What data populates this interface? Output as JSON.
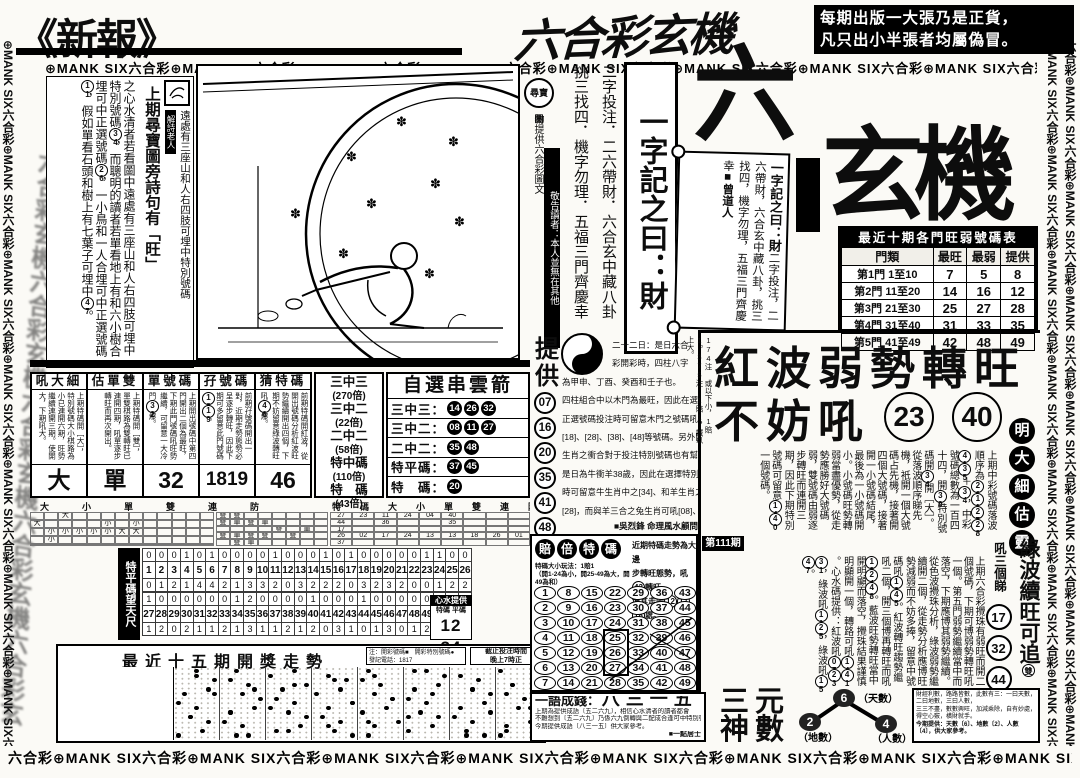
{
  "accent": {
    "ink": "#0d0d0d",
    "paper": "#fbfaf6"
  },
  "borders": {
    "strip_text": "⊕MANK SIX六合彩",
    "strip_text_alt": "六合彩⊕MANK SIX",
    "watermark": "六合彩玄機六合彩玄機六合彩玄機"
  },
  "masthead": {
    "left_logo": "《新報》",
    "center_logo": "六合彩玄機",
    "notice1": "每期出版一大張乃是正貨，",
    "notice2": "凡只出小半張者均屬偽冒。"
  },
  "left_article": {
    "seal_label": "解詩老人",
    "lead": "上期尋寶圖旁詩句有「旺」",
    "body": "之心水清者若看圖中遠處有三座山和人右四肢可埋中特別號碼(34)，而聰明的讀者若單看地上有和六小樹合埋可中正選號碼(26)，一小鳥和一人合埋可中正選號碼(11)，假如單看石頭和樹上有七葉子可埋中(47)。",
    "side_note": "遠處有三座山和人右四肢可埋中特別號碼"
  },
  "center": {
    "treasure_seal": "尋寶圖",
    "provider_note": "物提供六合彩圖文",
    "notice_bar": "敬告讀者：本人並無在其他",
    "col_pick": "挑三找四．機字勿理．五福三門齊慶幸",
    "col_bet": "二字投注．二六帶財．六合玄中藏八卦",
    "motto_box": "一字記之曰：財",
    "big_six": "六",
    "big_title": "玄機",
    "scroll": {
      "l1": "一字記之曰：財",
      "l2": "二字投注，二六帶財，",
      "l3": "六合玄中藏八卦，",
      "l4": "挑三找四，機字勿理，",
      "l5": "五福三門齊慶幸",
      "sign": "■曾道人"
    }
  },
  "hot_table": {
    "title": "最近十期各門旺弱號碼表",
    "rows": [
      [
        "門類",
        "最旺",
        "最弱",
        "提供"
      ],
      [
        "第1門 1至10",
        "7",
        "5",
        "8"
      ],
      [
        "第2門 11至20",
        "14",
        "16",
        "12"
      ],
      [
        "第3門 21至30",
        "25",
        "27",
        "28"
      ],
      [
        "第4門 31至40",
        "31",
        "33",
        "35"
      ],
      [
        "第5門 41至49",
        "42",
        "48",
        "49"
      ]
    ]
  },
  "provide": {
    "label": "提供",
    "numbers": [
      "07",
      "16",
      "20",
      "35",
      "41",
      "48"
    ],
    "lines": [
      "二十二日：是日六合",
      "彩開彩時，四柱八字",
      "為甲申、丁酉、癸酉和壬子也。",
      "四柱組合中以木門為最旺，因此在選擇",
      "正選號碼投注時可留意木門之號碼吼[08]",
      "[18]、[28]、[38]、[48]等號碼。另外開獎之日",
      "生肖之衝合對于投注特別號碼也有幫助，",
      "是日為牛衝羊38歲，因此在選擇特別號碼",
      "時可留意牛生肖中之[34]、和羊生肖之[06]、",
      "[28]，而與羊三合之兔生肖可吼[08]、[43]"
    ],
    "sign": "■吳烈鋒 命理風水顧問"
  },
  "prediction_boxes": [
    {
      "title": "吼大細",
      "note": "上期特碼開［大］，特別號碼大小棋路為小已連開六期，旺勢繼續連開三期。使開大，下期吼大。",
      "answer": "大"
    },
    {
      "title": "估單雙",
      "note": "上期特碼開［雙］，單雙棋路為雙轉旺已連開四期，吼單逐步轉旺而再次開出。",
      "answer": "單"
    },
    {
      "title": "單號碼",
      "note": "上期開出號碼中第四門開出二個為最旺，下期此門號碼吼旺勢繼續，可留意一大冷門(32)爆。",
      "answer": "32"
    },
    {
      "title": "孖號碼",
      "note": "前期孖號碼開出一對，近期走勢態勢必呈逐步轉旺，因此下期可多留意此門號碼(18)(19)。",
      "answer": "1819"
    },
    {
      "title": "猜特碼",
      "note": "前期特碼開紅波，從開出號碼分析紅波旺勢繼續開出四個，下期不妨留意綠波轉旺吼(46)爆。",
      "answer": "46"
    }
  ],
  "odds": [
    {
      "n": "三中三",
      "x": "(270倍)"
    },
    {
      "n": "三中二",
      "x": "(22倍)"
    },
    {
      "n": "二中二",
      "x": "(58倍)"
    },
    {
      "n": "特中碼",
      "x": "(110倍)"
    },
    {
      "n": "特　碼",
      "x": "(43倍)"
    }
  ],
  "arrow_box": {
    "title": "自選串雲箭",
    "rows": [
      {
        "label": "三中三：",
        "nums": [
          "14",
          "26",
          "32"
        ]
      },
      {
        "label": "三中二：",
        "nums": [
          "08",
          "11",
          "27"
        ]
      },
      {
        "label": "二中二：",
        "nums": [
          "35",
          "48"
        ]
      },
      {
        "label": "特平碼：",
        "nums": [
          "37",
          "45"
        ]
      },
      {
        "label": "特　碼：",
        "nums": [
          "20"
        ]
      }
    ]
  },
  "records": {
    "header1": "大　小　單　雙　連　防",
    "header2": "特　碼　大　小　單　雙　連　防",
    "grid_daxiao": [
      [
        "",
        "",
        "大",
        "",
        "",
        "",
        "",
        "",
        "",
        "",
        "",
        "",
        ""
      ],
      [
        "大",
        "",
        "",
        "",
        "",
        "小",
        "",
        "小",
        "",
        "",
        "",
        "",
        ""
      ],
      [
        "",
        "小",
        "小",
        "小",
        "小",
        "小",
        "大",
        "大",
        "",
        "",
        "",
        "",
        ""
      ],
      [
        "",
        "小",
        "",
        "",
        "",
        "",
        "",
        "",
        "",
        "",
        "",
        "",
        ""
      ],
      [
        "",
        "",
        "",
        "",
        "",
        "",
        "",
        "",
        "",
        "",
        "",
        "",
        ""
      ]
    ],
    "grid_danshuang": [
      [
        "雙",
        "雙",
        "",
        "",
        "",
        "",
        "",
        ""
      ],
      [
        "雙",
        "單",
        "雙",
        "單",
        "",
        "",
        "",
        ""
      ],
      [
        "",
        "",
        "",
        "",
        "雙",
        "",
        "單",
        ""
      ],
      [
        "雙",
        "單",
        "雙",
        "雙",
        "",
        "雙",
        "",
        ""
      ],
      [
        "",
        "雙",
        "單",
        "",
        "",
        "",
        "",
        ""
      ]
    ],
    "grid_numbers": [
      [
        "27",
        "23",
        "11",
        "24",
        "04",
        "40",
        "",
        "",
        ""
      ],
      [
        "44",
        "",
        "36",
        "",
        "",
        "35",
        "",
        "",
        ""
      ],
      [
        "17",
        "",
        "",
        "",
        "",
        "",
        "",
        "",
        ""
      ],
      [
        "26",
        "02",
        "17",
        "24",
        "13",
        "13",
        "18",
        "26",
        "01"
      ],
      [
        "37",
        "",
        "",
        "",
        "",
        "",
        "",
        "",
        ""
      ]
    ]
  },
  "freq": {
    "label": "特平碼望天尺",
    "above1": [
      0,
      0,
      0,
      1,
      0,
      1,
      0,
      0,
      0,
      0,
      1,
      0,
      0,
      0,
      1,
      0,
      1,
      0,
      0,
      0,
      0,
      0,
      1,
      1,
      0,
      0
    ],
    "below1": [
      0,
      1,
      2,
      1,
      4,
      4,
      2,
      1,
      3,
      3,
      2,
      0,
      3,
      2,
      2,
      2,
      0,
      3,
      2,
      3,
      2,
      0,
      0,
      1,
      2,
      2
    ],
    "above2": [
      1,
      0,
      0,
      0,
      0,
      0,
      0,
      1,
      2,
      0,
      0,
      0,
      0,
      1,
      0,
      0,
      0,
      1,
      0,
      0,
      0,
      0,
      0
    ],
    "below2": [
      1,
      2,
      0,
      2,
      1,
      1,
      2,
      1,
      3,
      1,
      1,
      2,
      1,
      2,
      0,
      3,
      1,
      0,
      1,
      3,
      0,
      1,
      2
    ],
    "tip_title": "心水提供",
    "tip_cols": "特碼 平碼",
    "tip_val": "12 34"
  },
  "trend": {
    "title": "最近十五期開獎走勢",
    "note1": "注：開彩號碼■　開彩特別號碼●",
    "note2": "發記電話：1817",
    "cutoff1": "截止投注時間",
    "cutoff2": "晚上7時正"
  },
  "payout": {
    "badges": [
      "賠",
      "倍",
      "特",
      "碼"
    ],
    "rule1": "特碼大小玩法：1賠1",
    "rule2": "（開1-24為小，開25-49為大，開49為和）",
    "note1": "近期特碼走勢為大邊",
    "note2": "步轉旺態勢，吼(43)轉旺",
    "note3": "博其走向(12)(17)(18)處。",
    "issue": "第111期"
  },
  "headline": {
    "line1": "紅波弱勢轉旺",
    "line2": "不妨吼",
    "n1": "23",
    "n2": "40",
    "side": "174注 或以下小，1賠1。375注 1賠1，誠以上大。"
  },
  "article_top": "上期中彩號碼落波順序為(26)(11)(27)(28)(41)(35)＋(34)，中彩號碼總數為一百四十四，開(39)特別號碼開(34)開［大］。從落波順序睇先機，衹開一個大號碼占先機，接著開四個大號碼，接著開一小號碼結尾，最後為一小號碼開小。小號碼旺勢轉弱當盡優勢，從走勢應勝好大號碼弱，雙號碼由弱逐步轉旺而連開三期，因此下期特別號碼可留意(14)(40)一個號碼。",
  "article_bottom": "上期六合彩攪珠有弱旺而開二個號碼，下期可博弱勢轉旺吼一個。第五門弱勢繼續當中而落空，下期應博其弱勢繼續。從色波攪珠分析，綠波弱勢繼續開二個，從走勢分析應博旺勢減弱而不妨多捧，留意中號碼吼(13)(45)。紅波轉旺趨勢繼吼二個，開三個博再轉旺而吼(12)(24)(48)。藍波旺勢轉旺當中開明顯而落空，攪珠結果謹慎明顯開一個，轉路可吼(14)(41)。心水碼提供：紅波吼(07)(23)(31)，綠波吼(11)(25)，綠波吼(15)(47)。",
  "sidebar": {
    "badge": [
      "明",
      "大",
      "細",
      "估",
      "靈"
    ],
    "green_title": "綠波續旺可追(雙)",
    "watch_label": "吼三個睇",
    "watch_nums": [
      "17",
      "32",
      "44"
    ]
  },
  "idiom": {
    "title": "一語成錢：",
    "phrase": "八三一五",
    "lines": [
      "上期為提供成語〔五二六九〕，相信心水清者的讀者都會",
      "不難想到〔五二六九〕乃係六九倒轉與二配成合逢可中特別號碼〔34〕",
      "今期提供成語〔八三一五〕供大家參考。"
    ],
    "sign": "■一點居士"
  },
  "sanyuan": {
    "title1": "三元",
    "title2": "神數",
    "top_num": "6",
    "top_label": "（天數）",
    "left_num": "2",
    "left_label": "（地數）",
    "right_num": "4",
    "right_label": "（人數）",
    "info1": "財經利數，路路皆數，此數有三：一曰天數，二曰地數，三曰人數，",
    "info2": "三三不盡，數數興旺，加減乘除，自有妙處，得空心竅，橫財就手。",
    "info3": "今期提供：天數〔6〕、地數〔2〕、人數〔4〕，供大家參考。"
  }
}
